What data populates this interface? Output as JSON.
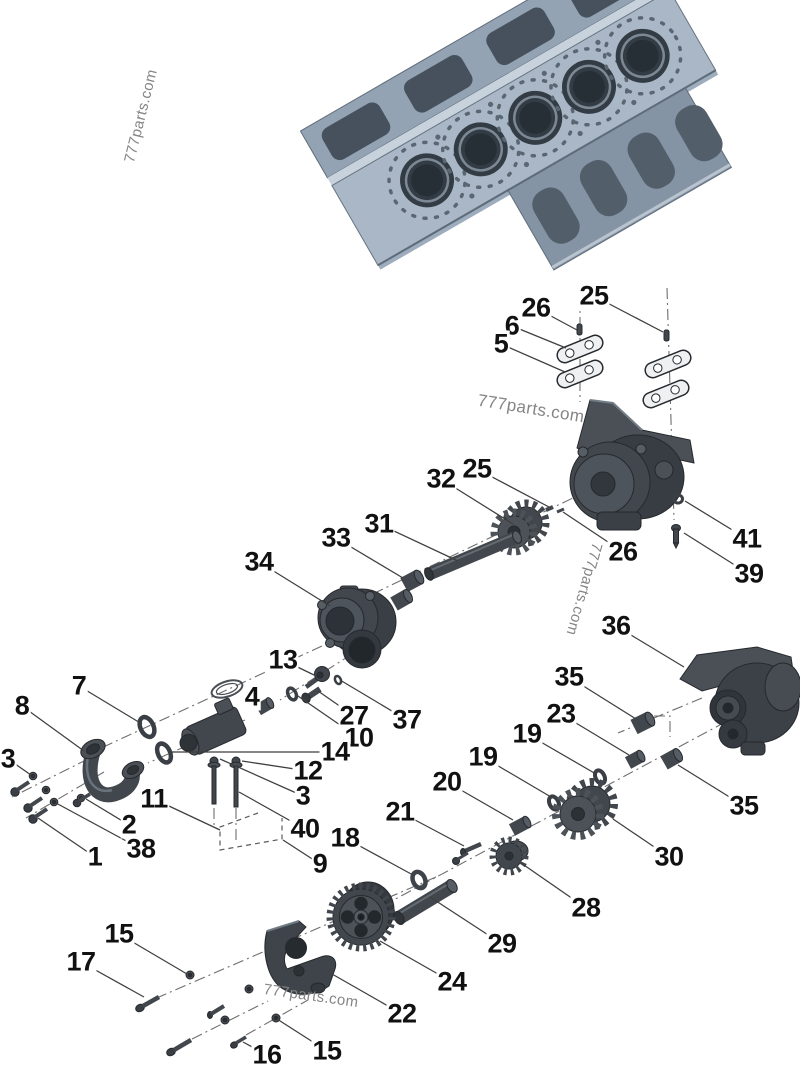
{
  "diagram": {
    "watermark_text": "777parts.com",
    "watermarks": [
      {
        "x": 141,
        "y": 116,
        "rotate": -76,
        "size": 15
      },
      {
        "x": 531,
        "y": 409,
        "rotate": 9,
        "size": 17
      },
      {
        "x": 584,
        "y": 589,
        "rotate": 106,
        "size": 15
      },
      {
        "x": 311,
        "y": 996,
        "rotate": 8,
        "size": 15
      }
    ],
    "callouts": [
      {
        "label": "25",
        "x": 594,
        "y": 296,
        "tx": 663,
        "ty": 332
      },
      {
        "label": "26",
        "x": 536,
        "y": 308,
        "tx": 577,
        "ty": 330
      },
      {
        "label": "6",
        "x": 512,
        "y": 326,
        "tx": 566,
        "ty": 348
      },
      {
        "label": "5",
        "x": 501,
        "y": 344,
        "tx": 565,
        "ty": 372
      },
      {
        "label": "41",
        "x": 747,
        "y": 539,
        "tx": 685,
        "ty": 501
      },
      {
        "label": "39",
        "x": 749,
        "y": 574,
        "tx": 684,
        "ty": 533
      },
      {
        "label": "26",
        "x": 623,
        "y": 552,
        "tx": 563,
        "ty": 512
      },
      {
        "label": "36",
        "x": 616,
        "y": 626,
        "tx": 684,
        "ty": 667
      },
      {
        "label": "25",
        "x": 477,
        "y": 469,
        "tx": 549,
        "ty": 507
      },
      {
        "label": "32",
        "x": 441,
        "y": 479,
        "tx": 513,
        "ty": 524
      },
      {
        "label": "31",
        "x": 379,
        "y": 524,
        "tx": 458,
        "ty": 561
      },
      {
        "label": "33",
        "x": 336,
        "y": 538,
        "tx": 403,
        "ty": 578
      },
      {
        "label": "34",
        "x": 259,
        "y": 562,
        "tx": 330,
        "ty": 606
      },
      {
        "label": "13",
        "x": 283,
        "y": 660,
        "tx": 314,
        "ty": 675
      },
      {
        "label": "4",
        "x": 252,
        "y": 697,
        "tx": 261,
        "ty": 704
      },
      {
        "label": "7",
        "x": 79,
        "y": 686,
        "tx": 142,
        "ty": 724
      },
      {
        "label": "8",
        "x": 22,
        "y": 706,
        "tx": 84,
        "ty": 751
      },
      {
        "label": "3",
        "x": 8,
        "y": 759,
        "tx": 31,
        "ty": 775
      },
      {
        "label": "27",
        "x": 354,
        "y": 716,
        "tx": 318,
        "ty": 691
      },
      {
        "label": "37",
        "x": 407,
        "y": 720,
        "tx": 340,
        "ty": 680
      },
      {
        "label": "10",
        "x": 359,
        "y": 738,
        "tx": 295,
        "ty": 694
      },
      {
        "label": "14",
        "x": 335,
        "y": 752,
        "tx": 172,
        "ty": 752
      },
      {
        "label": "12",
        "x": 308,
        "y": 771,
        "tx": 242,
        "ty": 761
      },
      {
        "label": "3",
        "x": 303,
        "y": 796,
        "tx": 220,
        "ty": 759
      },
      {
        "label": "40",
        "x": 305,
        "y": 829,
        "tx": 239,
        "ty": 792
      },
      {
        "label": "11",
        "x": 154,
        "y": 799,
        "tx": 220,
        "ty": 830
      },
      {
        "label": "9",
        "x": 320,
        "y": 864,
        "tx": 283,
        "ty": 840
      },
      {
        "label": "2",
        "x": 129,
        "y": 825,
        "tx": 86,
        "ty": 799
      },
      {
        "label": "38",
        "x": 141,
        "y": 849,
        "tx": 56,
        "ty": 803
      },
      {
        "label": "1",
        "x": 95,
        "y": 857,
        "tx": 38,
        "ty": 818
      },
      {
        "label": "35",
        "x": 569,
        "y": 677,
        "tx": 636,
        "ty": 719
      },
      {
        "label": "23",
        "x": 561,
        "y": 714,
        "tx": 629,
        "ty": 755
      },
      {
        "label": "19",
        "x": 527,
        "y": 734,
        "tx": 596,
        "ty": 774
      },
      {
        "label": "19",
        "x": 483,
        "y": 757,
        "tx": 551,
        "ty": 797
      },
      {
        "label": "20",
        "x": 447,
        "y": 782,
        "tx": 513,
        "ty": 820
      },
      {
        "label": "21",
        "x": 400,
        "y": 812,
        "tx": 464,
        "ty": 846
      },
      {
        "label": "18",
        "x": 345,
        "y": 838,
        "tx": 413,
        "ty": 875
      },
      {
        "label": "30",
        "x": 669,
        "y": 857,
        "tx": 613,
        "ty": 819
      },
      {
        "label": "35",
        "x": 744,
        "y": 806,
        "tx": 678,
        "ty": 765
      },
      {
        "label": "28",
        "x": 586,
        "y": 908,
        "tx": 521,
        "ty": 863
      },
      {
        "label": "29",
        "x": 502,
        "y": 944,
        "tx": 430,
        "ty": 897
      },
      {
        "label": "24",
        "x": 452,
        "y": 982,
        "tx": 380,
        "ty": 941
      },
      {
        "label": "22",
        "x": 402,
        "y": 1014,
        "tx": 332,
        "ty": 974
      },
      {
        "label": "15",
        "x": 119,
        "y": 934,
        "tx": 187,
        "ty": 974
      },
      {
        "label": "17",
        "x": 81,
        "y": 962,
        "tx": 144,
        "ty": 997
      },
      {
        "label": "16",
        "x": 267,
        "y": 1055,
        "tx": 243,
        "ty": 1042
      },
      {
        "label": "15",
        "x": 327,
        "y": 1051,
        "tx": 277,
        "ty": 1019
      }
    ],
    "colors": {
      "label": "#111111",
      "leader": "#3f3f3f",
      "centerline": "#6e6e6e",
      "watermark": "#858585",
      "part_dark": "#42474d",
      "block_steel": "#a9b7c6"
    }
  }
}
